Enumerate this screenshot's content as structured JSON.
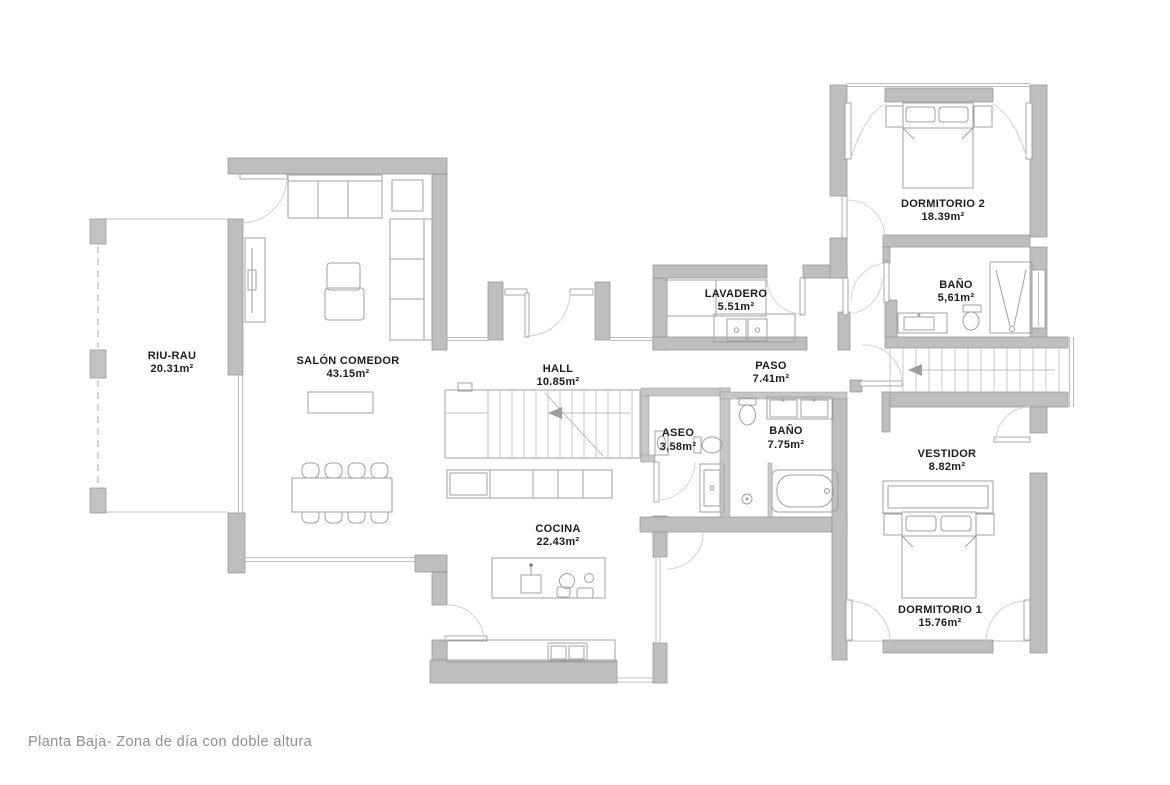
{
  "caption": "Planta Baja- Zona de día con doble altura",
  "rooms": [
    {
      "name": "RIU-RAU",
      "area": "20.31m²"
    },
    {
      "name": "SALÓN COMEDOR",
      "area": "43.15m²"
    },
    {
      "name": "HALL",
      "area": "10.85m²"
    },
    {
      "name": "LAVADERO",
      "area": "5.51m²"
    },
    {
      "name": "PASO",
      "area": "7.41m²"
    },
    {
      "name": "ASEO",
      "area": "3,58m²"
    },
    {
      "name": "BAÑO",
      "area": "7.75m²"
    },
    {
      "name": "COCINA",
      "area": "22.43m²"
    },
    {
      "name": "DORMITORIO 2",
      "area": "18.39m²"
    },
    {
      "name": "BAÑO",
      "area": "5,61m²"
    },
    {
      "name": "VESTIDOR",
      "area": "8.82m²"
    },
    {
      "name": "DORMITORIO 1",
      "area": "15.76m²"
    }
  ],
  "colors": {
    "background": "#ffffff",
    "wall_fill": "#bebebe",
    "wall_stroke": "#8f8f8f",
    "thin_line": "#9a9a9a",
    "furniture_line": "#a0a0a0",
    "door_arc": "#d2d2d2",
    "label_text": "#1d1d1d",
    "caption_text": "#8b8e92"
  }
}
